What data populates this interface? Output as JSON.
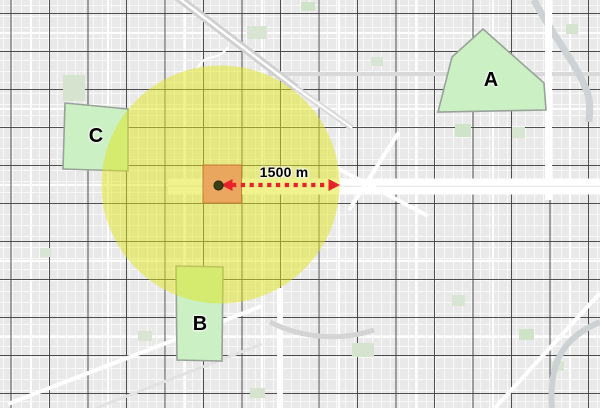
{
  "map": {
    "zone_labels": {
      "a": "A",
      "b": "B",
      "c": "C"
    },
    "buffer_distance_label": "1500 m",
    "colors": {
      "zone_fill": "#cbf0c4",
      "zone_stroke": "#98a398",
      "buffer_fill": "rgba(223,229,27,0.5)",
      "impact_square_fill": "#ea9a57",
      "impact_square_stroke": "#c97f36",
      "arrow": "#e7222b",
      "center_marker": "#39420f",
      "major_road": "#3e3e3e",
      "minor_road": "#ffffff",
      "map_background": "#e9e9e9",
      "park_green": "#d8e5d2",
      "rail_gray": "#cdd2d5"
    }
  }
}
